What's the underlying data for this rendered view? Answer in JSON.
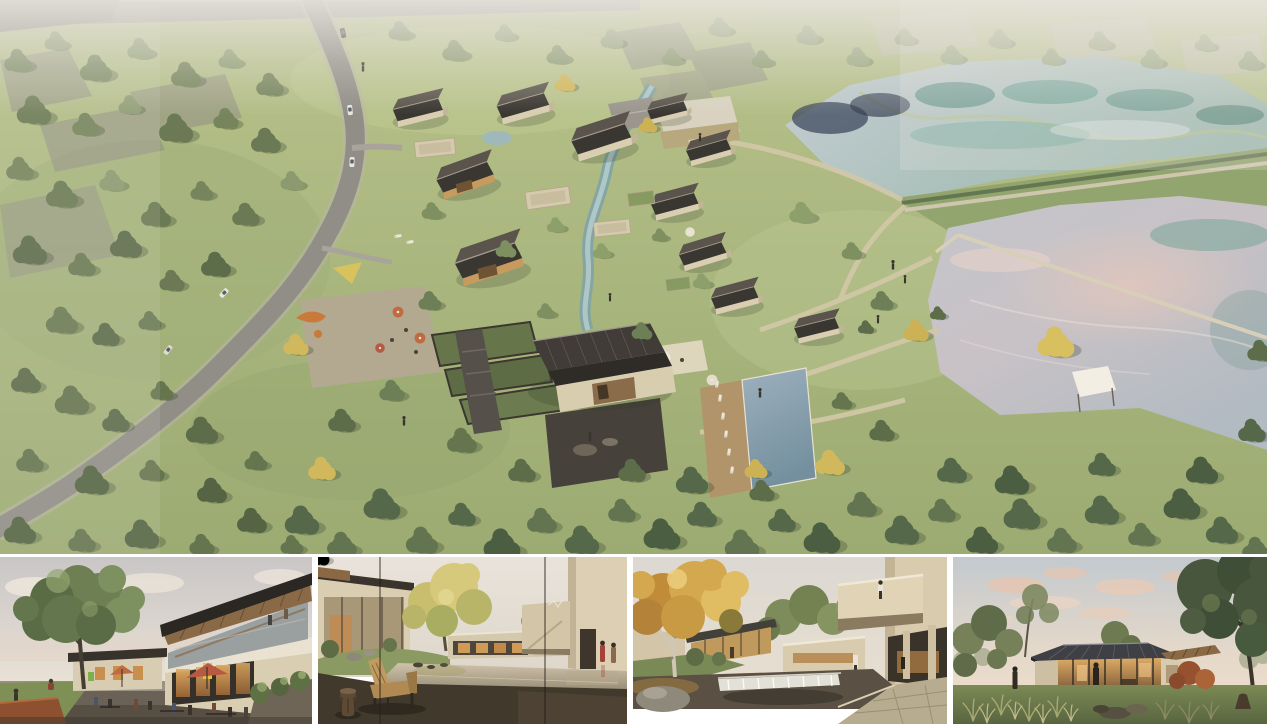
{
  "board": {
    "title": "Architectural rendering presentation board - rural resort village beside two ponds",
    "hero": {
      "description": "Aerial rendering of a village resort: clustered gabled houses with charcoal standing-seam roofs along a creek, stone terraced gardens, a plaza with orange umbrellas and a playground, a swimming pool with timber sun deck, lawns with winding paths, a curving country road through dense woodland on the left, translucent massing of the existing village at top, and two large ponds separated by a grass dam with walkways on the right."
    },
    "panels": [
      {
        "id": "plaza",
        "description": "Street-level view of the village plaza: cafe terraces with red and orange umbrellas, an illuminated yellow shop sign, people dining below a two-storey building with a tilted timber-soffit roof, a corten planter and a large green tree on the left."
      },
      {
        "id": "courtyard-pond",
        "description": "Courtyard seen through a glazed wall with two panel joints: a wooden lounge bench and a carved timber stool on a dark deck beside a mirror-like reflecting pond, cream houses with full-height glazing, a golden tree on a grass mound and two figures in red coats at the right."
      },
      {
        "id": "waterfall-court",
        "description": "Autumn courtyard: a golden-leafed tree with pale trunk and a boulder beside a dark pond with a white waterfall weir, low glazed pavilions with warm interiors and a cantilevered cream guest wing with a visitor standing on its roof terrace."
      },
      {
        "id": "dusk-pavilion",
        "description": "Lakeside pavilion at dusk: a low dark hipped standing-seam roof over a glowing glazed living space with a figure inside, a timber-roofed wing, framed by soft trees, a large dark tree at right, ornamental grasses, rocks and pink evening clouds."
      }
    ],
    "palette": {
      "canvas": "#ffffff",
      "grass": "#a9b67e",
      "grass_light": "#c3cc97",
      "woodland": "#76855c",
      "tree_dark": "#5d6d4a",
      "tree_light": "#8c9a70",
      "tree_yellow": "#d2b85c",
      "road": "#908e87",
      "roof_charcoal": "#3a3631",
      "wall_cream": "#d9cdb2",
      "stone": "#6b6355",
      "pond_upper": "#c2cad0",
      "pond_teal": "#3e7f72",
      "pond_slate": "#3f4a5e",
      "pond_lower": "#bcc1c8",
      "pond_pink": "#dcc7bf",
      "pool": "#7f97a8",
      "deck_wood": "#b2946a",
      "path_tan": "#d3c8a8",
      "umbrella_orange": "#c06a40",
      "umbrella_red": "#b65a43",
      "sign_yellow": "#e6c23c",
      "corten": "#8e5130",
      "sky_pale": "#dcd6cf",
      "cloud_pink": "#e8c4ae",
      "interior_glow": "#d49a55",
      "deck_dark": "#42392d",
      "bench_wood": "#b08a52",
      "autumn": "#d4a84e",
      "birch": "#cfc6b4",
      "weir_white": "#f2efe8",
      "dusk_roof": "#3f4046",
      "grass_tuft": "#a8a873"
    }
  }
}
